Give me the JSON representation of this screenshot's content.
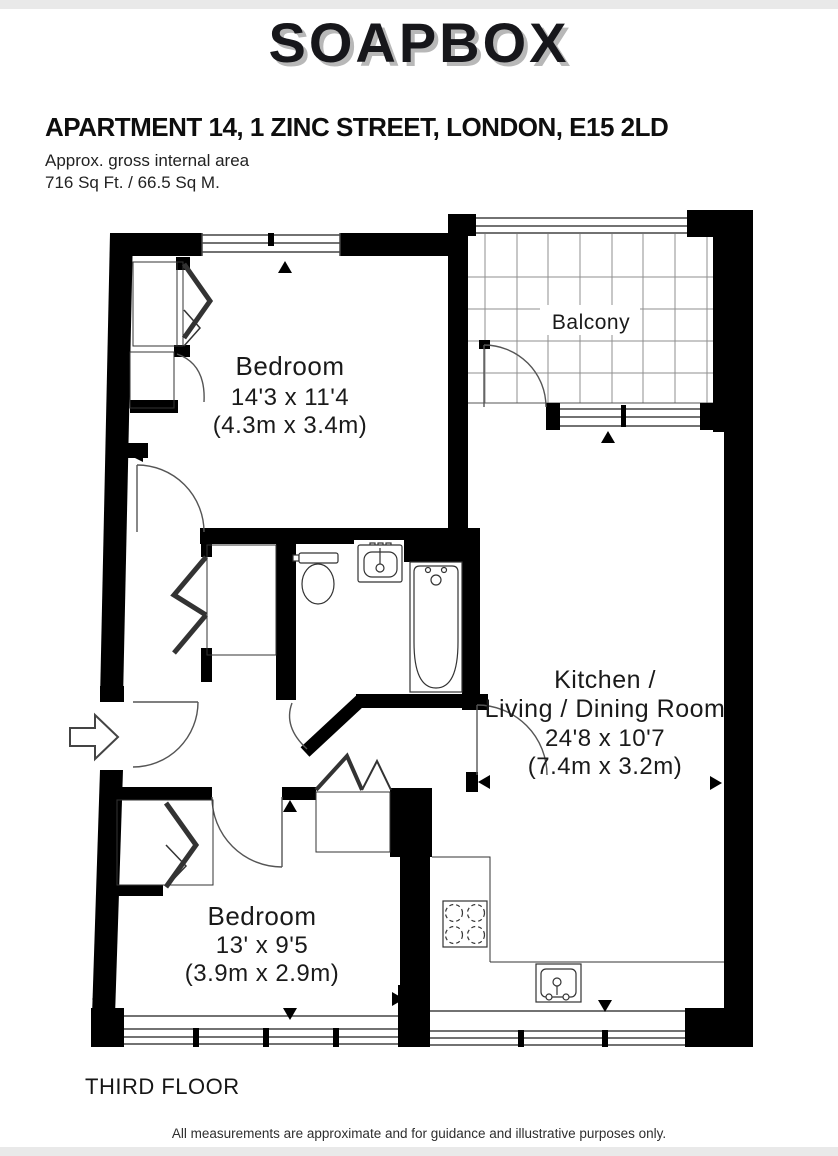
{
  "page": {
    "background": "#ffffff",
    "strip_color": "#e9e9e9"
  },
  "brand": {
    "logo_text": "SOAPBOX",
    "logo_color": "#17171b",
    "logo_shadow_color": "#b8b8b8"
  },
  "header": {
    "title": "APARTMENT 14, 1 ZINC STREET, LONDON, E15 2LD",
    "area_label": "Approx. gross internal area",
    "area_value": "716 Sq Ft. / 66.5 Sq M."
  },
  "floorplan": {
    "wall_color": "#000000",
    "grid_color": "#8f8f8f",
    "rooms": {
      "bedroom1": {
        "name": "Bedroom",
        "imperial": "14'3 x 11'4",
        "metric": "(4.3m x 3.4m)"
      },
      "balcony": {
        "name": "Balcony"
      },
      "kitchen_living": {
        "line1": "Kitchen /",
        "line2": "Living / Dining Room",
        "imperial": "24'8 x 10'7",
        "metric": "(7.4m x 3.2m)"
      },
      "bedroom2": {
        "name": "Bedroom",
        "imperial": "13' x 9'5",
        "metric": "(3.9m x 2.9m)"
      }
    }
  },
  "footer": {
    "floor_label": "THIRD FLOOR",
    "disclaimer": "All measurements are approximate and for guidance and illustrative purposes only."
  }
}
